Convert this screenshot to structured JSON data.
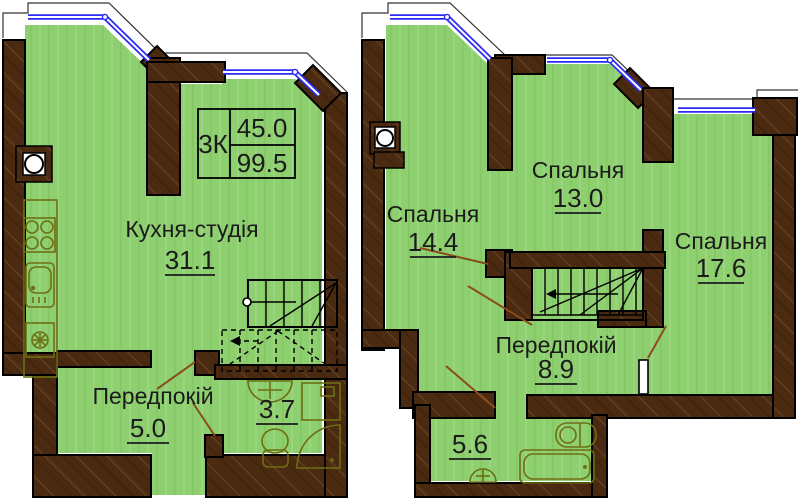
{
  "document_type": "apartment-floor-plan-two-levels",
  "colors": {
    "floor": "#8ecf70",
    "floor_stripe": "#9ad67f",
    "wall": "#4a2a10",
    "wall_hatch": "#5f3d1f",
    "window": "#2b2bf5",
    "fixture": "#6e6e14",
    "door_swing": "#8a4b1e",
    "text": "#1b1b1b"
  },
  "left_plan": {
    "info_box": {
      "type": "3К",
      "area_level": "45.0",
      "area_total": "99.5"
    },
    "kitchen": {
      "name": "Кухня-студія",
      "area": "31.1"
    },
    "hallway": {
      "name": "Передпокій",
      "area": "5.0"
    },
    "bathroom": {
      "area": "3.7"
    }
  },
  "right_plan": {
    "bedroom1": {
      "name": "Спальня",
      "area": "14.4"
    },
    "bedroom2": {
      "name": "Спальня",
      "area": "13.0"
    },
    "bedroom3": {
      "name": "Спальня",
      "area": "17.6"
    },
    "hallway": {
      "name": "Передпокій",
      "area": "8.9"
    },
    "bathroom": {
      "area": "5.6"
    }
  }
}
